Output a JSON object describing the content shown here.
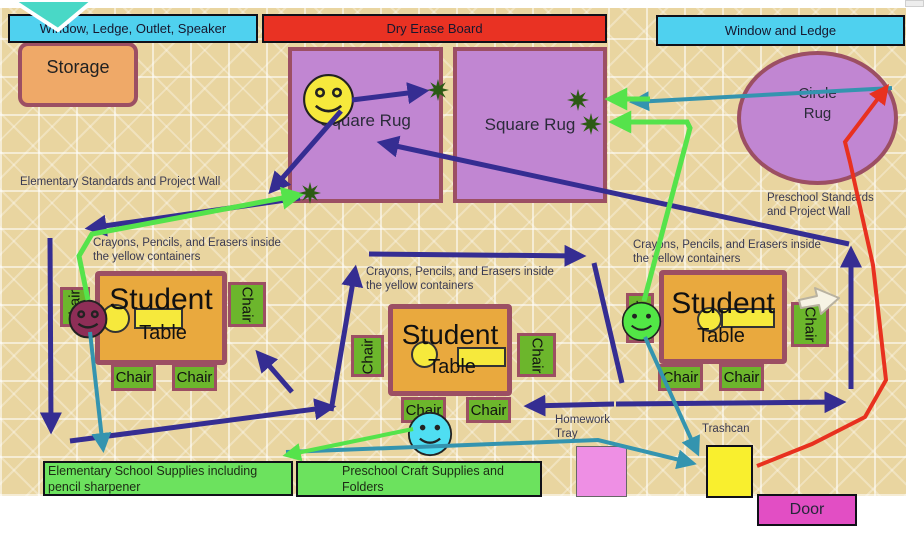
{
  "top_labels": {
    "window_ledge_outlet_speaker": "Window, Ledge, Outlet, Speaker",
    "dry_erase_board": "Dry Erase Board",
    "window_and_ledge": "Window and Ledge"
  },
  "areas": {
    "storage": "Storage",
    "square_rug": "Square Rug",
    "circle_rug_line1": "Circle",
    "circle_rug_line2": "Rug"
  },
  "furniture": {
    "student": "Student",
    "table": "Table",
    "chair": "Chair"
  },
  "texts": {
    "elementary_standards": "Elementary Standards and Project Wall",
    "preschool_standards": "Preschool Standards and Project Wall",
    "crayons": "Crayons, Pencils, and Erasers inside the yellow containers",
    "homework_tray": "Homework Tray",
    "trashcan": "Trashcan"
  },
  "bottom": {
    "elementary_supplies": "Elementary School Supplies including pencil sharpener",
    "preschool_supplies": "Preschool Craft Supplies and Folders",
    "door": "Door"
  },
  "colors": {
    "navy": "#352d92",
    "teal": "#3494af",
    "green": "#55e34b",
    "red": "#e8311f",
    "star": "#2c5a14",
    "background_tan": "#e9d5a0",
    "cyan_label": "#4fd1ef",
    "red_board": "#e93223",
    "rug_purple": "#c186d2",
    "rug_border_maroon": "#9c4f63",
    "table_orange": "#e9a93e",
    "chair_green": "#6cb62c",
    "storage_orange": "#efa968",
    "supplies_green": "#6ce25e",
    "tray_pink": "#ee8fe4",
    "trash_yellow": "#f9ef2e",
    "door_magenta": "#e24ec4",
    "smiley_yellow": "#f6e93c",
    "smiley_maroon": "#8e2e57",
    "smiley_green": "#52e746",
    "smiley_cyan": "#4fdef2"
  },
  "stars": [
    {
      "x": 438,
      "y": 90
    },
    {
      "x": 310,
      "y": 193
    },
    {
      "x": 578,
      "y": 100
    },
    {
      "x": 591,
      "y": 124
    }
  ],
  "arrows": [
    {
      "name": "smiley-to-star-a",
      "color": "navy",
      "width": 5,
      "points": [
        [
          352,
          100
        ],
        [
          424,
          91
        ]
      ]
    },
    {
      "name": "smiley-to-rug-corner",
      "color": "navy",
      "width": 5,
      "points": [
        [
          341,
          111
        ],
        [
          272,
          190
        ]
      ]
    },
    {
      "name": "rug-corner-to-left",
      "color": "navy",
      "width": 5,
      "points": [
        [
          300,
          198
        ],
        [
          90,
          228
        ]
      ]
    },
    {
      "name": "left-wall-down",
      "color": "navy",
      "width": 5,
      "points": [
        [
          50,
          238
        ],
        [
          51,
          429
        ]
      ]
    },
    {
      "name": "bottom-left-to-right",
      "color": "navy",
      "width": 5,
      "points": [
        [
          70,
          441
        ],
        [
          331,
          407
        ]
      ]
    },
    {
      "name": "to-table1",
      "color": "navy",
      "width": 5,
      "points": [
        [
          292,
          392
        ],
        [
          259,
          354
        ]
      ]
    },
    {
      "name": "table2-left-up",
      "color": "navy",
      "width": 5,
      "points": [
        [
          331,
          411
        ],
        [
          355,
          270
        ]
      ]
    },
    {
      "name": "table2-top-right",
      "color": "navy",
      "width": 5,
      "points": [
        [
          369,
          254
        ],
        [
          581,
          256
        ]
      ]
    },
    {
      "name": "table2-right-down",
      "color": "navy",
      "width": 5,
      "head": false,
      "points": [
        [
          594,
          263
        ],
        [
          622,
          383
        ]
      ]
    },
    {
      "name": "to-table2-chairs",
      "color": "navy",
      "width": 5,
      "points": [
        [
          614,
          404
        ],
        [
          529,
          406
        ]
      ]
    },
    {
      "name": "bottom-mid-to-right",
      "color": "navy",
      "width": 5,
      "points": [
        [
          616,
          404
        ],
        [
          841,
          402
        ]
      ]
    },
    {
      "name": "right-side-up",
      "color": "navy",
      "width": 5,
      "points": [
        [
          851,
          389
        ],
        [
          851,
          251
        ]
      ]
    },
    {
      "name": "right-to-rug1",
      "color": "navy",
      "width": 5,
      "points": [
        [
          849,
          244
        ],
        [
          382,
          143
        ]
      ]
    },
    {
      "name": "circle-rug-to-star",
      "color": "teal",
      "width": 4,
      "points": [
        [
          892,
          88
        ],
        [
          634,
          102
        ]
      ]
    },
    {
      "name": "maroon-smiley-to-supplies",
      "color": "teal",
      "width": 4,
      "points": [
        [
          90,
          332
        ],
        [
          103,
          448
        ]
      ]
    },
    {
      "name": "green-smiley-to-trashcan",
      "color": "teal",
      "width": 4,
      "points": [
        [
          645,
          337
        ],
        [
          697,
          452
        ]
      ]
    },
    {
      "name": "across-to-trashcan",
      "color": "teal",
      "width": 4,
      "points": [
        [
          286,
          452
        ],
        [
          598,
          440
        ],
        [
          692,
          463
        ]
      ]
    },
    {
      "name": "maroon-smiley-to-star",
      "color": "green",
      "width": 5,
      "points": [
        [
          88,
          300
        ],
        [
          79,
          256
        ],
        [
          92,
          234
        ],
        [
          299,
          195
        ]
      ]
    },
    {
      "name": "green-smiley-to-star",
      "color": "green",
      "width": 5,
      "points": [
        [
          644,
          301
        ],
        [
          690,
          128
        ],
        [
          687,
          122
        ],
        [
          614,
          122
        ]
      ]
    },
    {
      "name": "short-to-star",
      "color": "green",
      "width": 5,
      "points": [
        [
          650,
          99
        ],
        [
          610,
          99
        ]
      ]
    },
    {
      "name": "cyan-smiley-to-supplies",
      "color": "green",
      "width": 4,
      "points": [
        [
          413,
          429
        ],
        [
          287,
          455
        ]
      ]
    },
    {
      "name": "trashcan-to-circle-rug",
      "color": "red",
      "width": 4,
      "points": [
        [
          757,
          466
        ],
        [
          812,
          444
        ],
        [
          865,
          417
        ],
        [
          886,
          380
        ],
        [
          873,
          265
        ],
        [
          850,
          162
        ],
        [
          845,
          142
        ],
        [
          886,
          88
        ]
      ]
    }
  ]
}
